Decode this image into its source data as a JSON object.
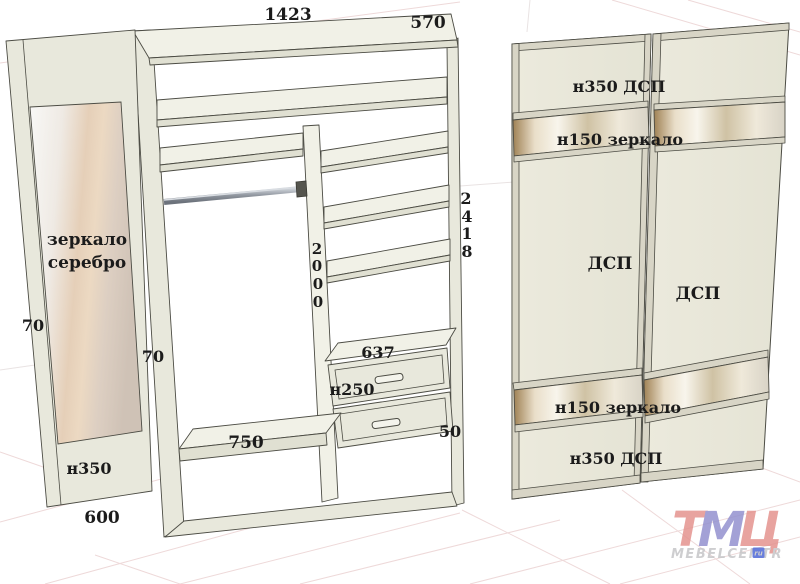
{
  "diagram": {
    "carcass": {
      "width": "1423",
      "depth": "570",
      "total_height": [
        "2",
        "4",
        "1",
        "8"
      ],
      "interior_height": [
        "2",
        "0",
        "0",
        "0"
      ],
      "drawer_unit_width": "637",
      "drawer_front_height": "н250",
      "bottom_shelf_width": "750",
      "side_gap": "50"
    },
    "mirror_panel": {
      "material_line1": "зеркало",
      "material_line2": "серебро",
      "edge_top": "70",
      "edge_side": "70",
      "bottom_height": "н350",
      "panel_width": "600"
    },
    "doors": {
      "top_section": "н350 ДСП",
      "upper_mirror": "н150 зеркало",
      "left_door_material": "ДСП",
      "right_door_material": "ДСП",
      "lower_mirror": "н150 зеркало",
      "bottom_section": "н350 ДСП"
    },
    "logo": {
      "letters": [
        "Т",
        "М",
        "Ц"
      ],
      "brand": "MEBELCENTR",
      "badge": "ru"
    },
    "colors": {
      "panel": "#e8e8dc",
      "accent_pink": "#e4938f",
      "accent_violet": "#9391cf",
      "badge_blue": "#4e68d6",
      "grid_pink": "#eed9d9"
    }
  }
}
